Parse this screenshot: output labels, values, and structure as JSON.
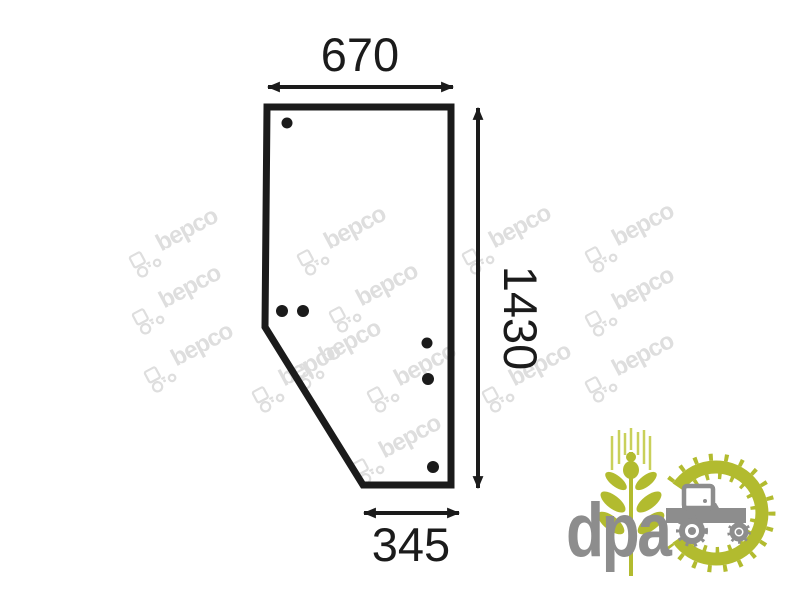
{
  "product_diagram": {
    "description": "Door glass panel outline with mounting holes",
    "line_color": "#1b1b1b",
    "outline_points": "267,107 451,107 451,485 363,485 265,327",
    "dimension_labels": {
      "top_width": "670",
      "side_height": "1430",
      "bottom_width": "345"
    },
    "holes": [
      {
        "cx": 287,
        "cy": 123,
        "r": 5.5
      },
      {
        "cx": 282,
        "cy": 311,
        "r": 6
      },
      {
        "cx": 303,
        "cy": 311,
        "r": 6
      },
      {
        "cx": 427,
        "cy": 343,
        "r": 5.5
      },
      {
        "cx": 428,
        "cy": 379,
        "r": 6
      },
      {
        "cx": 433,
        "cy": 467,
        "r": 6
      }
    ]
  },
  "watermark": {
    "text": "bepco",
    "color": "#dedede",
    "angle_deg": -28,
    "positions": [
      [
        172,
        238
      ],
      [
        340,
        236
      ],
      [
        505,
        235
      ],
      [
        628,
        233
      ],
      [
        175,
        295
      ],
      [
        372,
        293
      ],
      [
        628,
        297
      ],
      [
        187,
        353
      ],
      [
        335,
        350
      ],
      [
        628,
        363
      ],
      [
        295,
        373
      ],
      [
        410,
        373
      ],
      [
        525,
        373
      ],
      [
        395,
        445
      ]
    ]
  },
  "brand_logo": {
    "text": "dpa",
    "green": "#b2bb2f",
    "light_green": "#c9d05a",
    "gray": "#8d8d8d"
  }
}
